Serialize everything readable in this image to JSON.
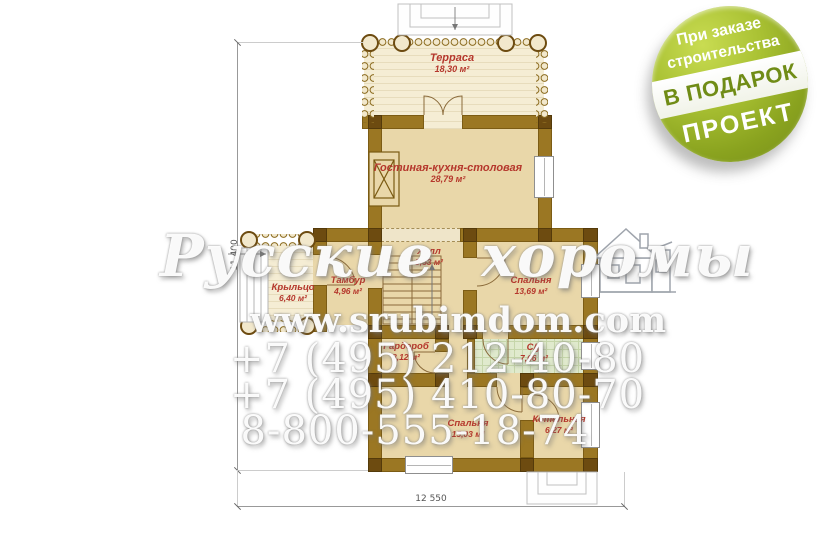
{
  "plan": {
    "rooms": [
      {
        "name": "Терраса",
        "area": "18,30 м²"
      },
      {
        "name": "Гостиная-кухня-столовая",
        "area": "28,79 м²"
      },
      {
        "name": "Крыльцо",
        "area": "6,40 м²"
      },
      {
        "name": "Тамбур",
        "area": "4,96 м²"
      },
      {
        "name": "Холл",
        "area": "8,53 м²"
      },
      {
        "name": "Спальня",
        "area": "13,69 м²"
      },
      {
        "name": "Гардероб",
        "area": "8,12 м²"
      },
      {
        "name": "С/у",
        "area": "7,66 м²"
      },
      {
        "name": "Спальня",
        "area": "15,03 м²"
      },
      {
        "name": "Котельная",
        "area": "6,27 м²"
      }
    ],
    "dimensions": {
      "width": "12 550",
      "height": "11 400"
    }
  },
  "watermark": {
    "brand": "Русские хоромы",
    "site": "www.srubimdom.com",
    "phone1": "+7 (495) 212-40-80",
    "phone2": "+7 (495) 410-80-70",
    "phone3": "8-800-555-18-74"
  },
  "badge": {
    "line1": "При заказе",
    "line2": "строительства",
    "band": "В ПОДАРОК",
    "line3": "ПРОЕКТ"
  },
  "colors": {
    "label_red": "#b5372c",
    "wall_brown": "#9b7723",
    "badge_green": "#8aa31f",
    "bath_green": "#e0eacd"
  }
}
